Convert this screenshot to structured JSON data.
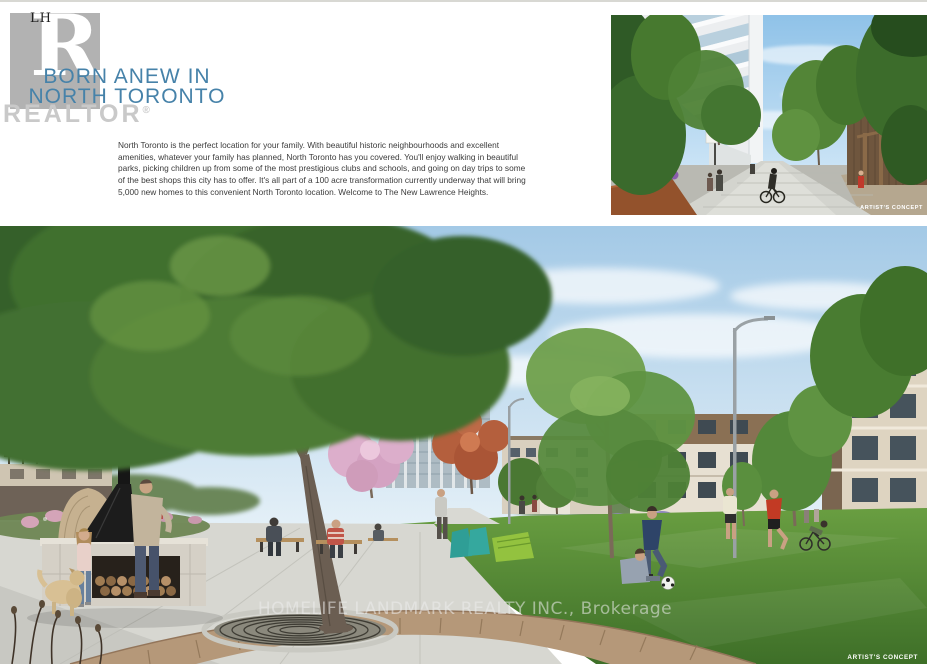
{
  "page": {
    "lh_monogram": "LH",
    "realtor_word": "REALTOR",
    "registered": "®"
  },
  "hero": {
    "heading_line1": "BORN ANEW IN",
    "heading_line2": "NORTH TORONTO",
    "paragraph": "North Toronto is the perfect location for your family. With beautiful historic neighbourhoods and excellent amenities, whatever your family has planned, North Toronto has you covered. You'll enjoy walking in beautiful parks, picking children up from some of the most prestigious clubs and schools, and going on day trips to some of the best shops this city has to offer. It's all part of a 100 acre transformation currently underway that will bring 5,000 new homes to this convenient North Toronto location. Welcome to The New Lawrence Heights."
  },
  "walkway_image": {
    "credit": "ARTIST'S CONCEPT"
  },
  "park_image": {
    "credit": "ARTIST'S CONCEPT",
    "watermark": "HOMELIFE LANDMARK REALTY INC., Brokerage"
  },
  "colors": {
    "heading_blue": "#4682a9",
    "body_text": "#3b3b3b",
    "logo_gray": "#b2b2b2",
    "realtor_text": "#c9c9c9",
    "top_rule": "#d8d8d3"
  }
}
